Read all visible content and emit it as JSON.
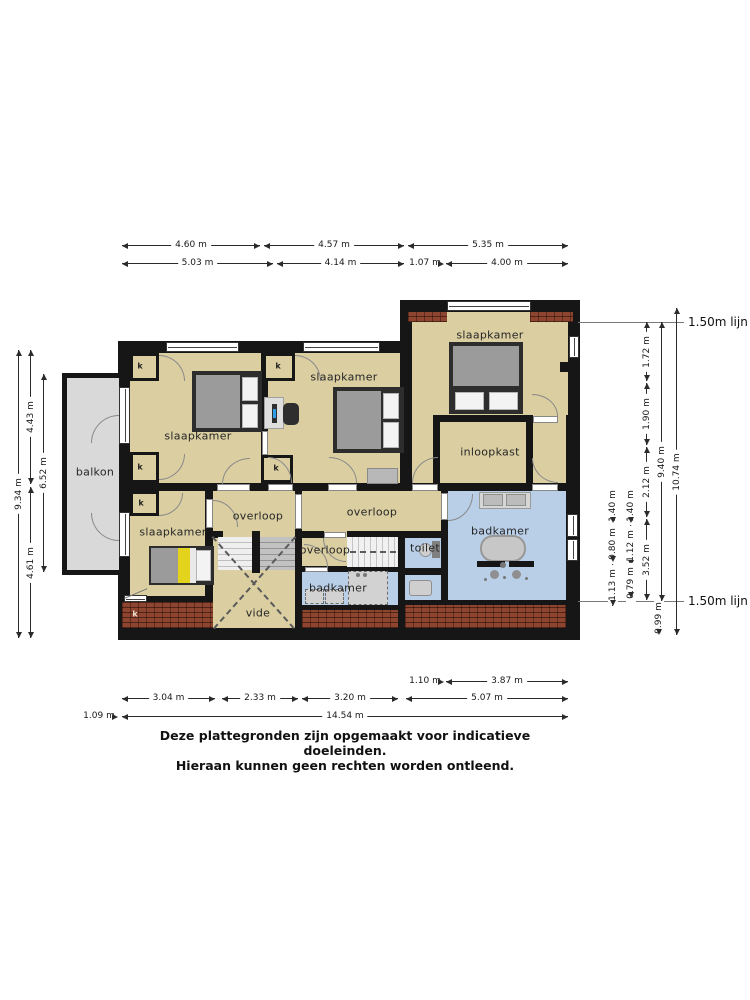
{
  "labels": {
    "slaapkamer": "slaapkamer",
    "inloopkast": "inloopkast",
    "balkon": "balkon",
    "overloop": "overloop",
    "vide": "vide",
    "toilet": "toilet",
    "badkamer": "badkamer",
    "kast": "k"
  },
  "dims": {
    "top1": [
      "4.60 m",
      "4.57 m",
      "5.35 m"
    ],
    "top2": [
      "5.03 m",
      "4.14 m",
      "1.07 m",
      "4.00 m"
    ],
    "left": {
      "total": "9.34 m",
      "upper": "4.43 m",
      "lower": "4.61 m",
      "balkon": "6.52 m"
    },
    "right": {
      "seg1": "1.72 m",
      "seg2": "1.90 m",
      "seg3": "2.12 m",
      "seg4": "3.52 m",
      "seg5": "0.99 m",
      "inner_total": "9.40 m",
      "total": "10.74 m",
      "a1": "1.40 m",
      "a2": "0.80 m",
      "a3": "1.13 m",
      "b1": "1.40 m",
      "b2": "1.12 m",
      "b3": "0.79 m",
      "line_label": "1.50m lijn"
    },
    "bottom1": [
      "1.10 m",
      "3.87 m"
    ],
    "bottom2": [
      "3.04 m",
      "2.33 m",
      "3.20 m",
      "5.07 m"
    ],
    "bottom3": [
      "1.09 m",
      "14.54 m"
    ]
  },
  "disclaimer": {
    "line1": "Deze plattegronden zijn opgemaakt voor indicatieve doeleinden.",
    "line2": "Hieraan kunnen geen rechten worden ontleend."
  },
  "colors": {
    "wall": "#161616",
    "room": "#dbcfa2",
    "wet_room": "#b9cfe7",
    "balcony": "#d9d9d9",
    "brick": "#8d4530"
  }
}
